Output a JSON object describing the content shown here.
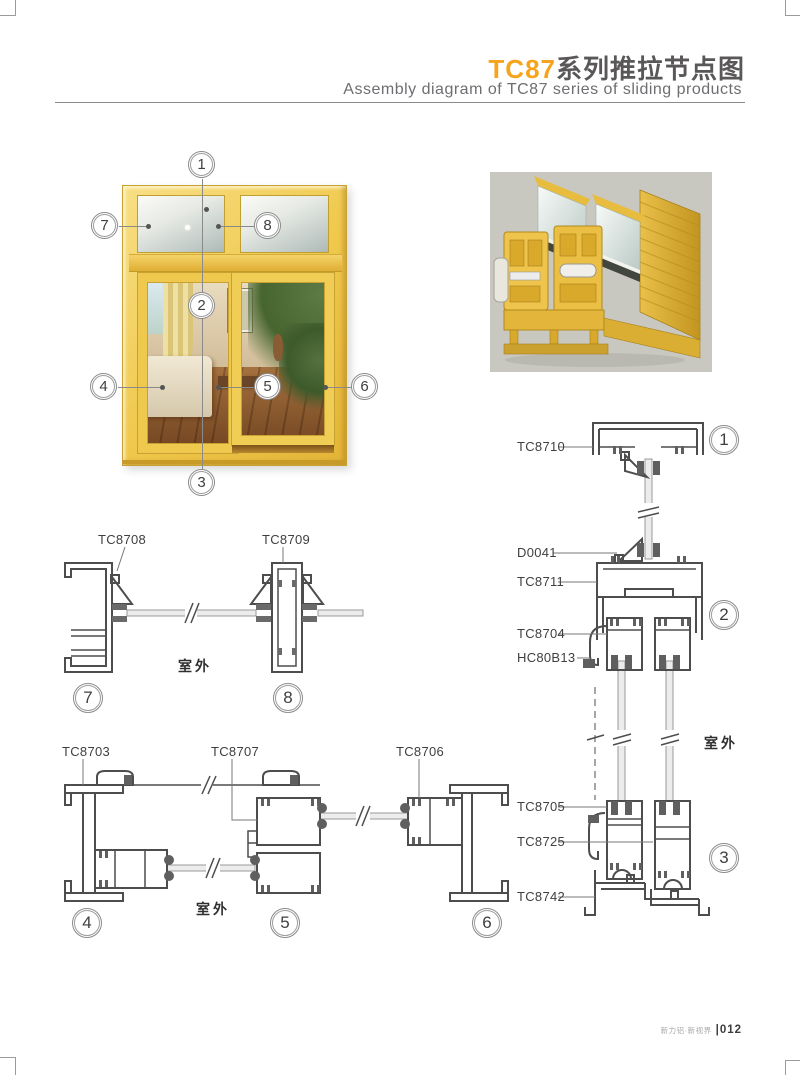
{
  "page": {
    "header": {
      "title_highlight": "TC87",
      "title_rest": "系列推拉节点图",
      "subtitle": "Assembly diagram of TC87 series of sliding products",
      "accent_color": "#F6A41D",
      "heading_color": "#595757"
    },
    "footer": {
      "brand": "新力铝·新视界",
      "separator": "|",
      "page_number": "012"
    }
  },
  "figures": {
    "window": {
      "callouts": [
        "1",
        "2",
        "3",
        "4",
        "5",
        "6",
        "7",
        "8"
      ]
    }
  },
  "sections": {
    "outdoor_label": "室外",
    "top_detail": {
      "labels": {
        "left": "TC8708",
        "right": "TC8709"
      },
      "callouts": [
        "7",
        "8"
      ]
    },
    "mid_detail": {
      "labels": {
        "left": "TC8703",
        "center": "TC8707",
        "right": "TC8706"
      },
      "callouts": [
        "4",
        "5",
        "6"
      ]
    },
    "right_detail": {
      "labels": [
        "TC8710",
        "D0041",
        "TC8711",
        "TC8704",
        "HC80B13",
        "TC8705",
        "TC8725",
        "TC8742"
      ],
      "callouts": [
        "1",
        "2",
        "3"
      ]
    }
  }
}
